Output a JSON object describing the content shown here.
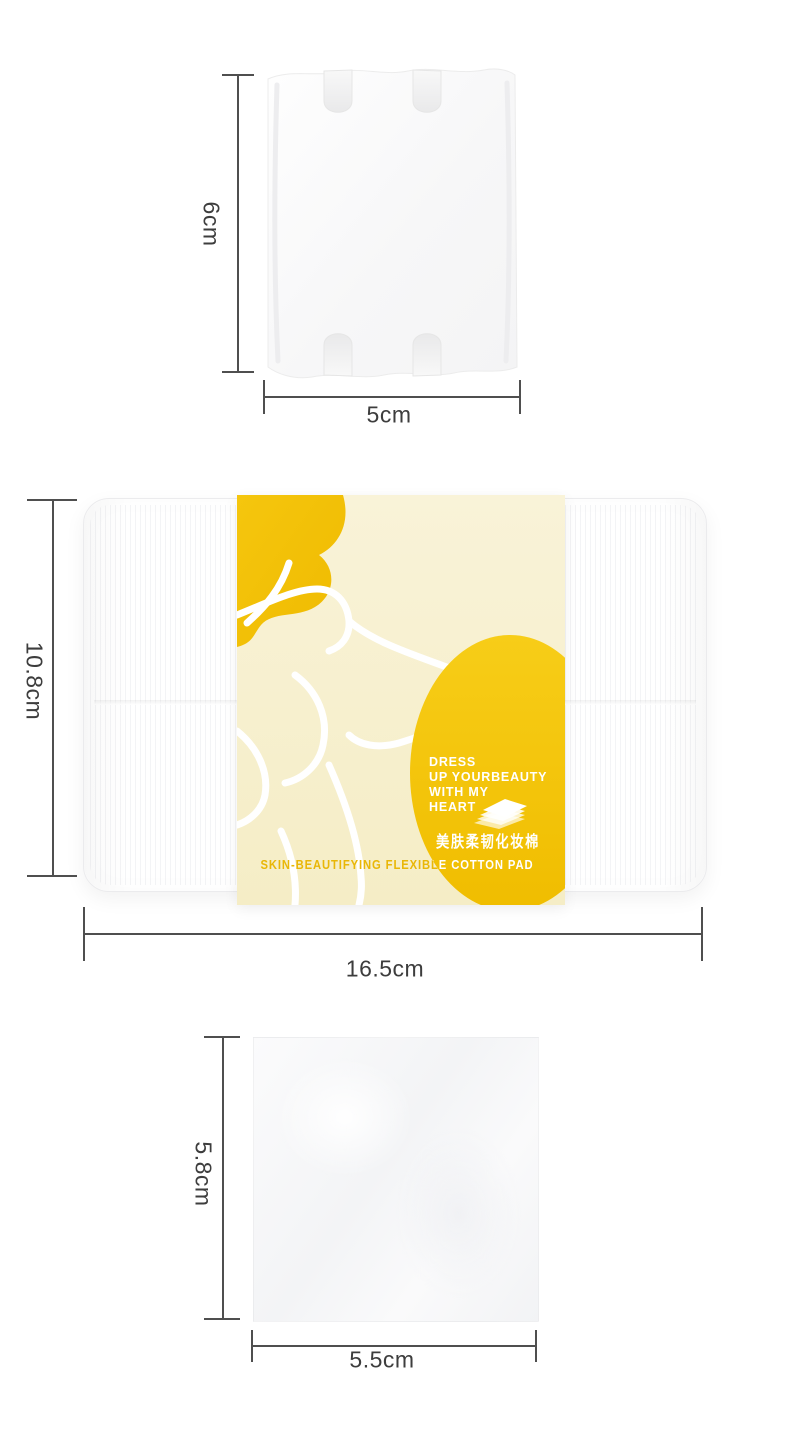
{
  "colors": {
    "brand_yellow": "#F3C402",
    "label_cream": "#F7F0CF",
    "dimension_gray": "#4F4F4F",
    "text_gray": "#3D3D3D"
  },
  "pad_top": {
    "height_label": "6cm",
    "width_label": "5cm"
  },
  "box": {
    "height_label": "10.8cm",
    "width_label": "16.5cm",
    "label": {
      "slogan": [
        "DRESS",
        "UP YOURBEAUTY",
        "WITH MY",
        "HEART"
      ],
      "name_cn": "美肤柔韧化妆棉",
      "name_en": "SKIN-BEAUTIFYING FLEXIBLE COTTON PAD"
    }
  },
  "pad_bottom": {
    "height_label": "5.8cm",
    "width_label": "5.5cm"
  }
}
